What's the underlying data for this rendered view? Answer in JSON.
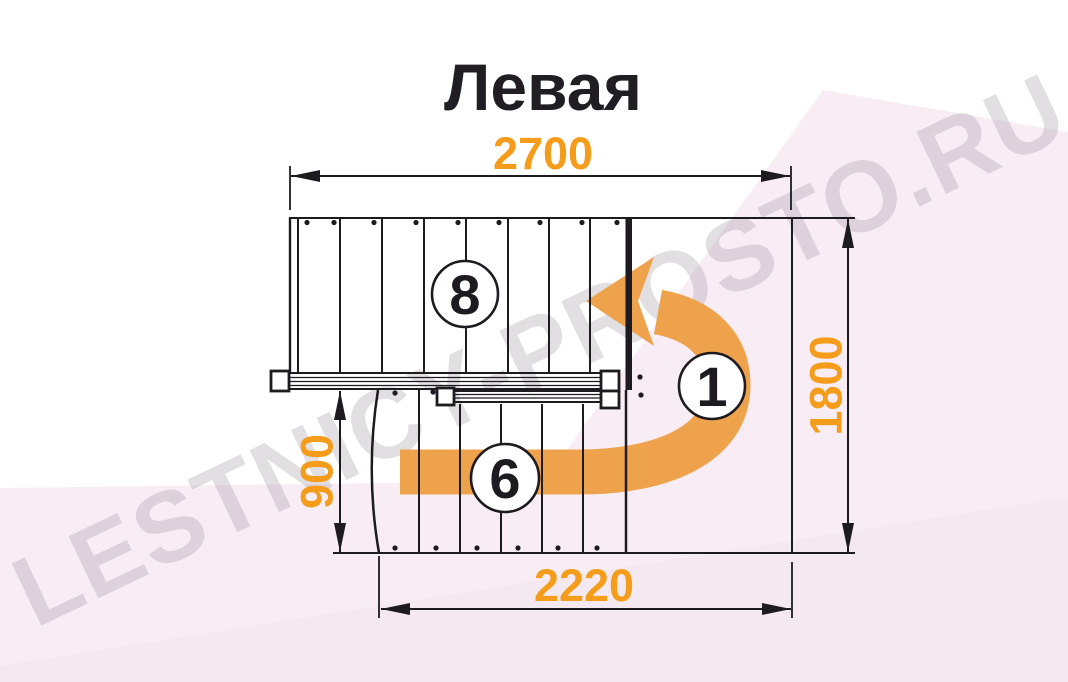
{
  "title": "Левая",
  "dimensions": {
    "top": "2700",
    "bottom": "2220",
    "left": "900",
    "right": "1800",
    "unit": "mm"
  },
  "flights": {
    "upper_steps": "8",
    "lower_steps": "6",
    "landing_number": "1"
  },
  "watermark": "LESTNICY-PROSTO.RU",
  "colors": {
    "dimension_text": "#f59c1a",
    "direction_arrow": "#efa24c",
    "drawing_lines": "#1d1b20",
    "background_facet": "#f8edf4"
  }
}
